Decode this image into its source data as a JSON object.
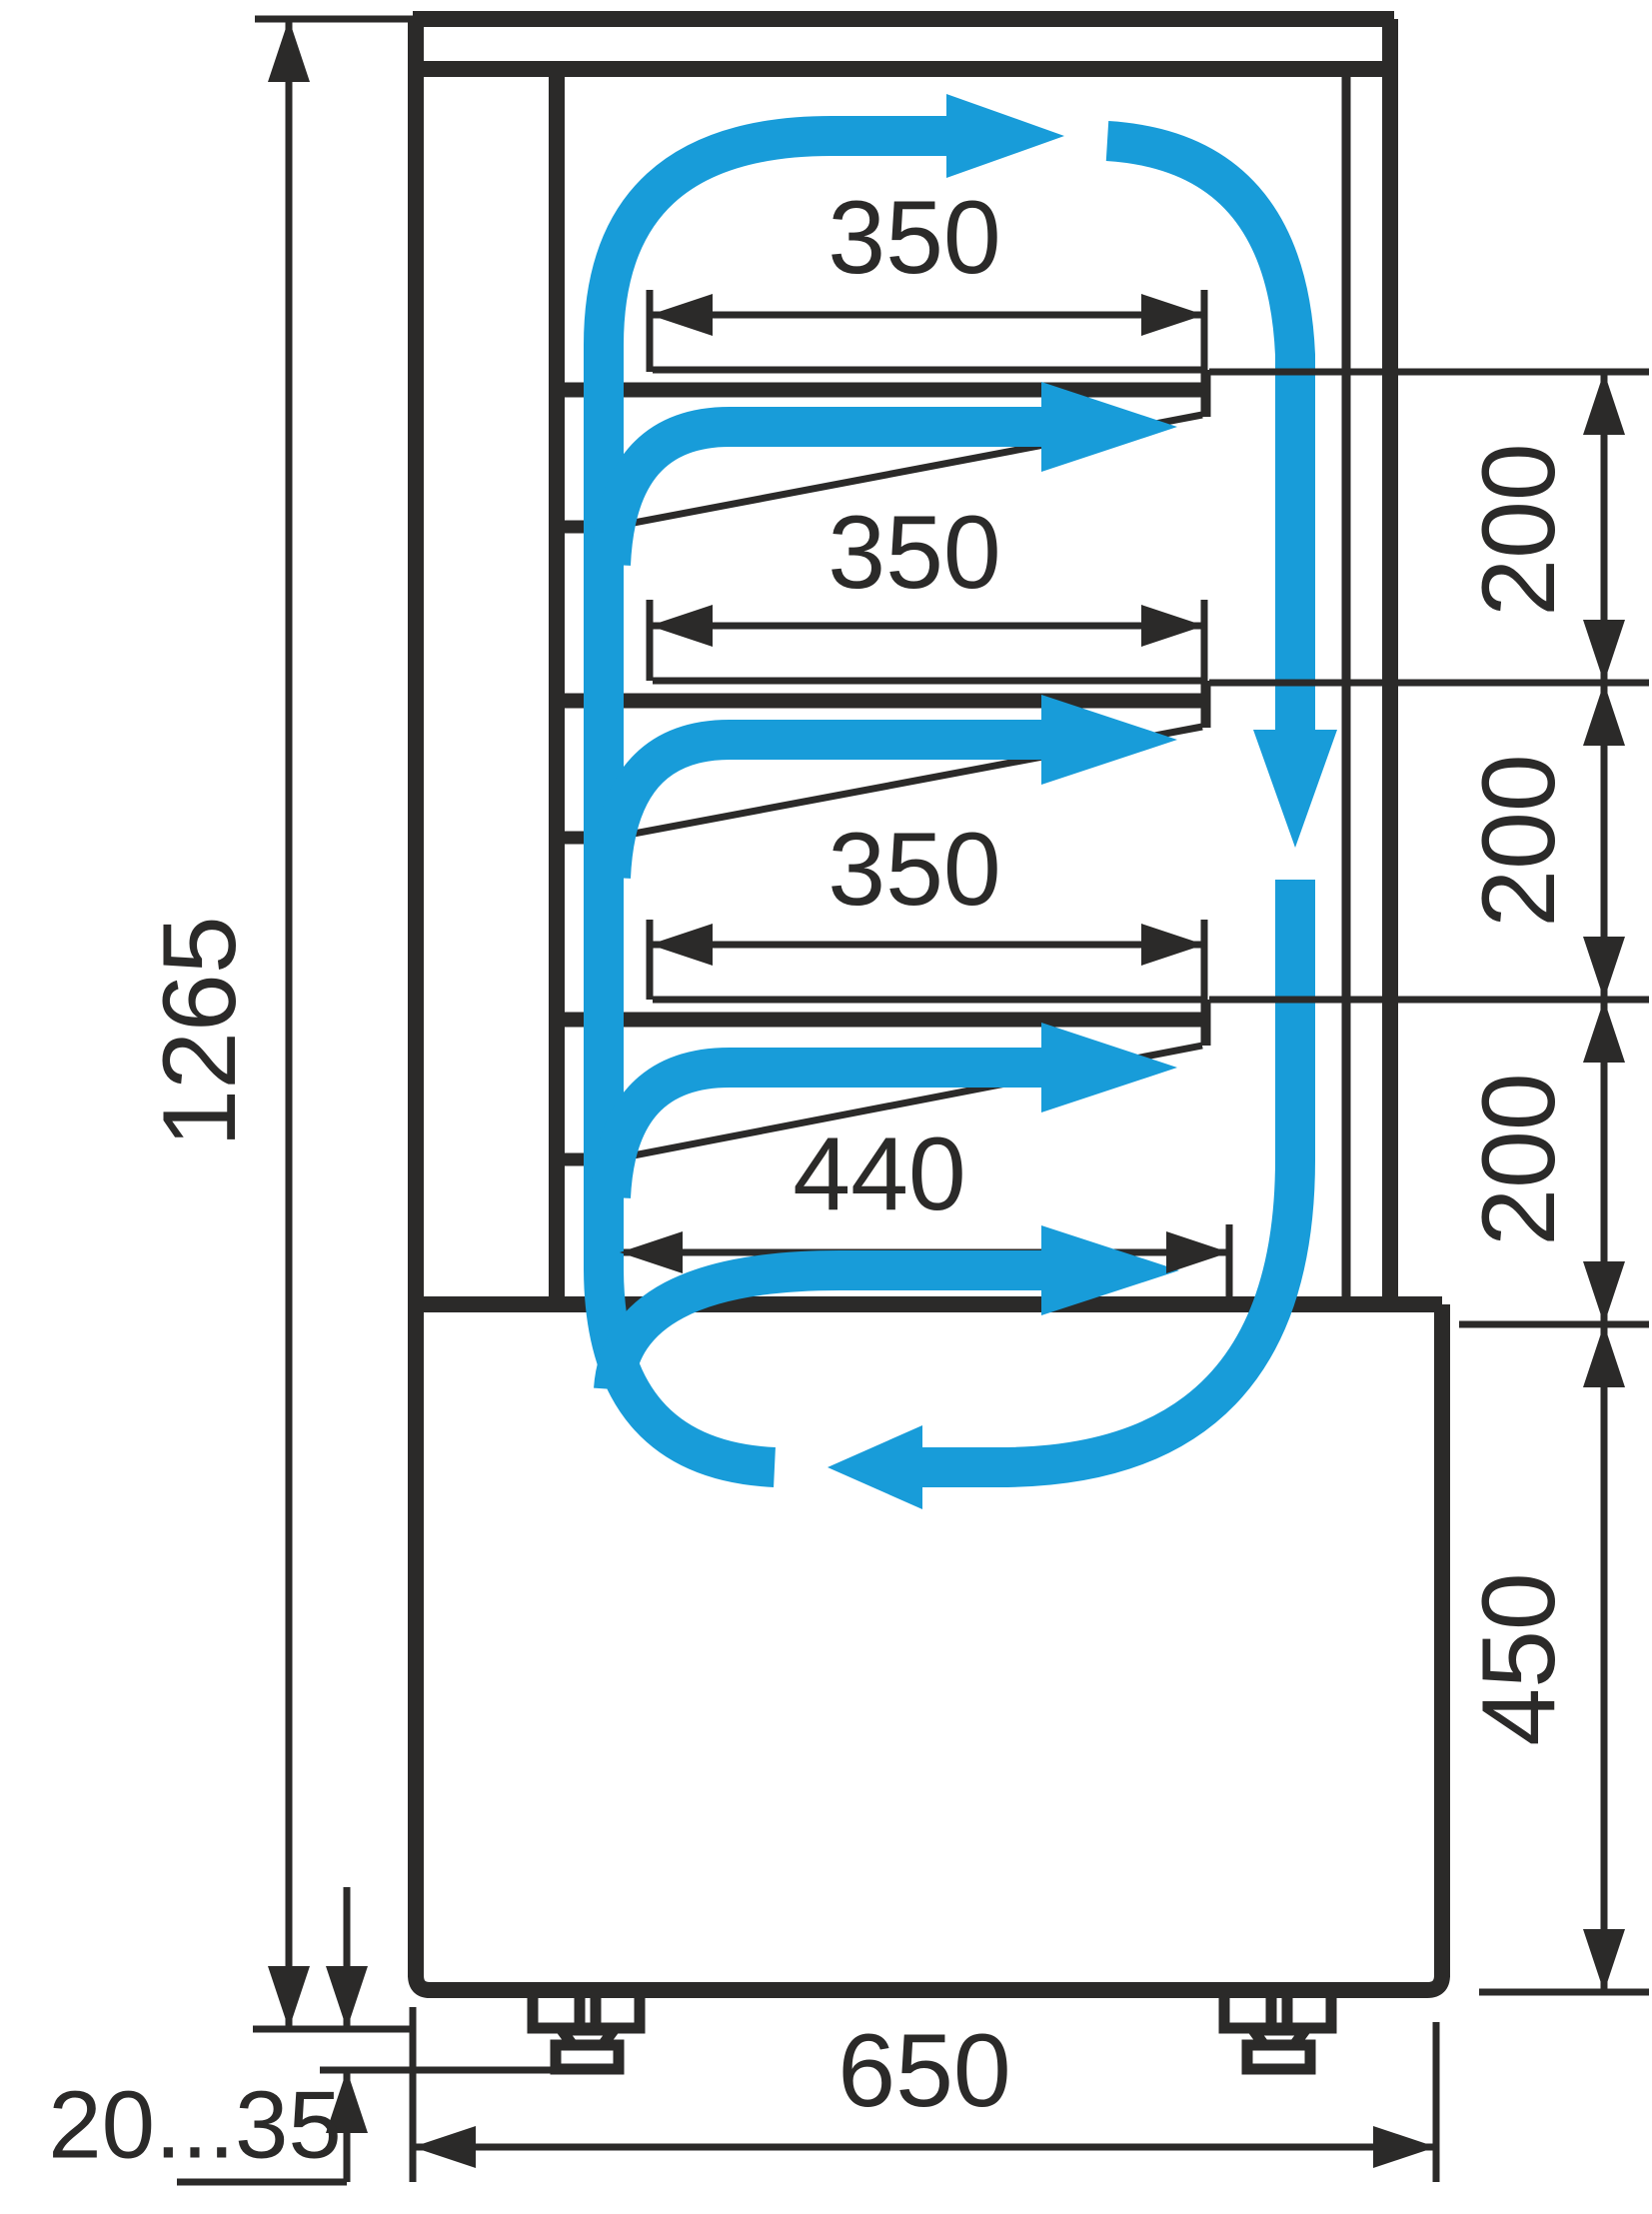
{
  "labels": {
    "overall_height": "1265",
    "shelf_depth": "350",
    "bottom_shelf_depth": "440",
    "shelf_spacing": "200",
    "base_height": "450",
    "base_depth": "650",
    "foot_adjust_range": "20...35"
  },
  "colors": {
    "line": "#2b2a29",
    "accent": "#189cd9",
    "background": "#ffffff"
  }
}
